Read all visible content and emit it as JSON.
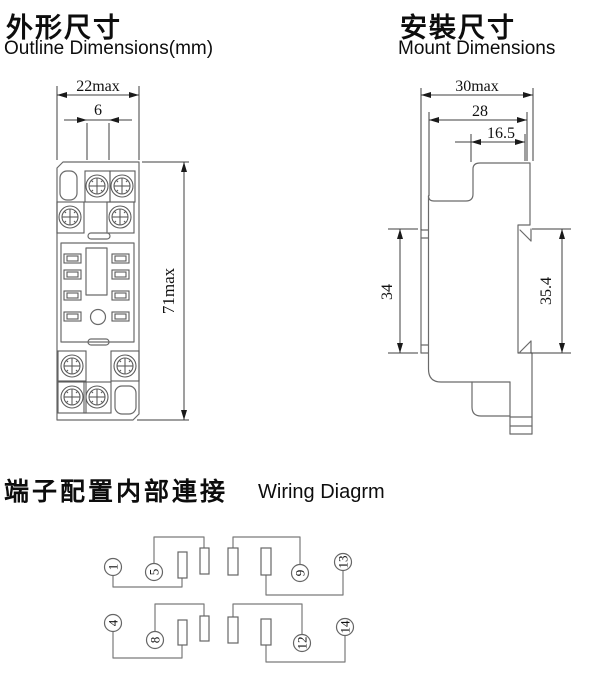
{
  "outline_section": {
    "title_zh": "外形尺寸",
    "title_en": "Outline Dimensions(mm)",
    "dim_width": "22max",
    "dim_center": "6",
    "dim_height": "71max"
  },
  "mount_section": {
    "title_zh": "安裝尺寸",
    "title_en": "Mount Dimensions",
    "dim_depth_max": "30max",
    "dim_depth": "28",
    "dim_top": "16.5",
    "dim_rail": "34",
    "dim_back": "35.4"
  },
  "wiring_section": {
    "title_zh": "端子配置内部連接",
    "title_en": "Wiring Diagrm",
    "terminals": [
      "1",
      "5",
      "9",
      "13",
      "4",
      "8",
      "12",
      "14"
    ]
  }
}
